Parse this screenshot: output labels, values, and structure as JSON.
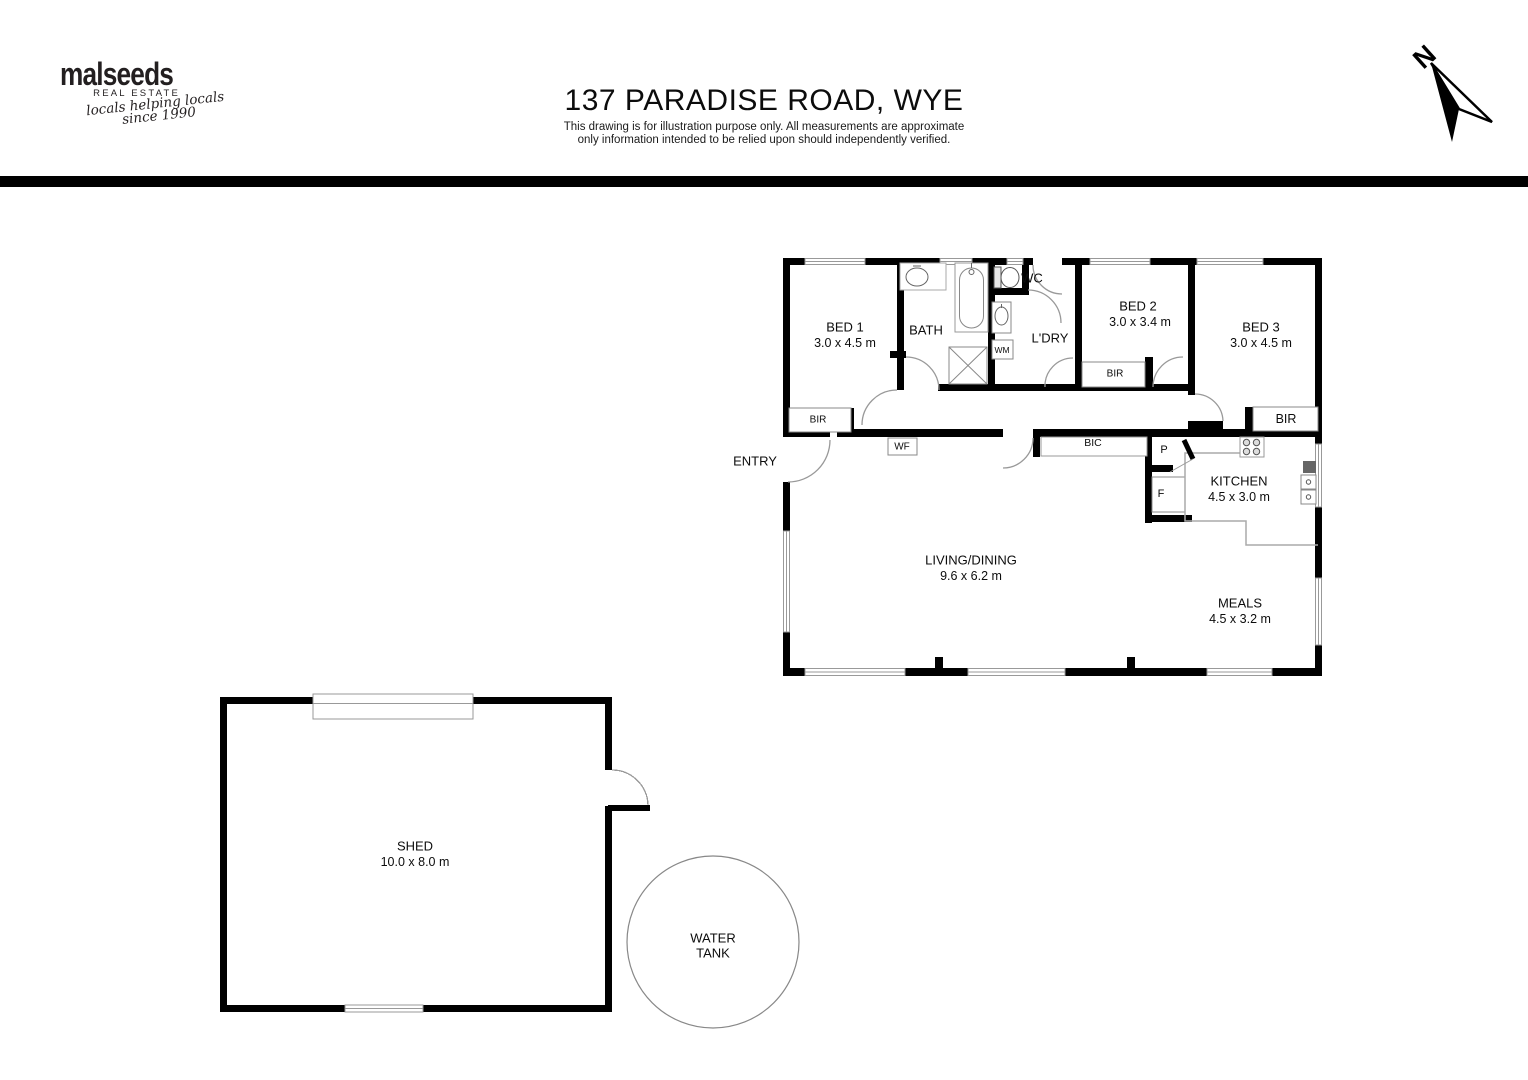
{
  "header": {
    "logo": {
      "brand": "malseeds",
      "tagline": "REAL ESTATE",
      "script_line1": "locals helping locals",
      "script_line2": "since 1990"
    },
    "title": "137 PARADISE ROAD, WYE",
    "disclaimer_line1": "This drawing is for illustration purpose only. All measurements are approximate",
    "disclaimer_line2": "only information intended to be relied upon should independently verified.",
    "compass": {
      "label": "N"
    }
  },
  "floorplan": {
    "house": {
      "bed1": {
        "name": "BED 1",
        "dims": "3.0 x 4.5 m"
      },
      "bath": {
        "name": "BATH"
      },
      "wc": {
        "name": "WC"
      },
      "laundry": {
        "name": "L'DRY"
      },
      "bed2": {
        "name": "BED 2",
        "dims": "3.0 x  3.4 m"
      },
      "bed3": {
        "name": "BED 3",
        "dims": "3.0 x 4.5 m"
      },
      "kitchen": {
        "name": "KITCHEN",
        "dims": "4.5 x 3.0 m"
      },
      "living": {
        "name": "LIVING/DINING",
        "dims": "9.6 x 6.2 m"
      },
      "meals": {
        "name": "MEALS",
        "dims": "4.5 x 3.2 m"
      },
      "entry": {
        "name": "ENTRY"
      }
    },
    "fixtures": {
      "bir": "BIR",
      "bic": "BIC",
      "wood_fire": "WF",
      "washing_machine": "WM",
      "pantry": "P",
      "fridge": "F"
    },
    "outbuildings": {
      "shed": {
        "name": "SHED",
        "dims": "10.0 x 8.0 m"
      },
      "water_tank": {
        "line1": "WATER",
        "line2": "TANK"
      }
    }
  },
  "colors": {
    "wall": "#000000",
    "divider": "#000000",
    "window_line": "#999999",
    "fixture_line": "#888888",
    "text": "#0c0c0c"
  }
}
